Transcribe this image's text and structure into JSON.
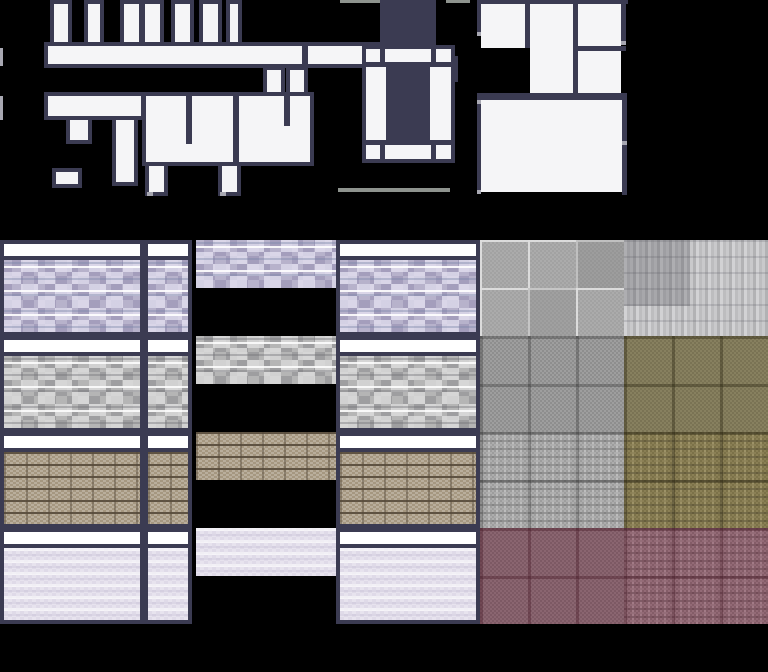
{
  "canvas": {
    "width": 768,
    "height": 672,
    "background": "#000000"
  },
  "palette": {
    "outline_dark_navy": "#3b3b52",
    "wall_white": "#f5f5f7",
    "band_white": "#ffffff",
    "doorway_cap_gray": "#a8a8b2",
    "ground_line_gray": "#8e938e",
    "stone_purple": "#b7b2cb",
    "stone_gray": "#b5b5b5",
    "brick_brown": "#a59780",
    "tile_lavender": "#e7e3ee",
    "floor_light_gray": "#ababab",
    "plank_gray": "#c2c2c4",
    "checker_gray": "#989898",
    "checker_olive": "#81795c",
    "checker_maroon": "#846070"
  },
  "top_section": {
    "pieces": [
      {
        "name": "wall-stub-1",
        "kind": "white",
        "x": 50,
        "y": 0,
        "w": 22,
        "h": 46
      },
      {
        "name": "wall-stub-2",
        "kind": "white",
        "x": 84,
        "y": 0,
        "w": 20,
        "h": 46
      },
      {
        "name": "wall-stub-3",
        "kind": "white",
        "x": 120,
        "y": 0,
        "w": 23,
        "h": 48
      },
      {
        "name": "wall-stub-4",
        "kind": "white",
        "x": 141,
        "y": 0,
        "w": 23,
        "h": 48
      },
      {
        "name": "wall-stub-5",
        "kind": "white",
        "x": 171,
        "y": 0,
        "w": 23,
        "h": 48
      },
      {
        "name": "wall-stub-6",
        "kind": "white",
        "x": 199,
        "y": 0,
        "w": 23,
        "h": 48
      },
      {
        "name": "wall-stub-7",
        "kind": "white",
        "x": 226,
        "y": 0,
        "w": 16,
        "h": 48
      },
      {
        "name": "corridor-upper-left",
        "kind": "white",
        "x": 44,
        "y": 42,
        "w": 262,
        "h": 26
      },
      {
        "name": "corridor-upper-right",
        "kind": "white",
        "x": 304,
        "y": 42,
        "w": 94,
        "h": 26
      },
      {
        "name": "corridor-upper-step",
        "kind": "white",
        "x": 396,
        "y": 56,
        "w": 62,
        "h": 26
      },
      {
        "name": "corridor-drop-stub-1",
        "kind": "white",
        "x": 263,
        "y": 66,
        "w": 22,
        "h": 30
      },
      {
        "name": "corridor-drop-stub-2",
        "kind": "white",
        "x": 286,
        "y": 66,
        "w": 22,
        "h": 30
      },
      {
        "name": "edge-sliver-1",
        "kind": "cap",
        "x": 0,
        "y": 48,
        "w": 3,
        "h": 18
      },
      {
        "name": "edge-sliver-2",
        "kind": "cap",
        "x": 0,
        "y": 96,
        "w": 3,
        "h": 24
      },
      {
        "name": "room-blob",
        "kind": "white",
        "x": 142,
        "y": 92,
        "w": 172,
        "h": 74
      },
      {
        "name": "corridor-lower-left",
        "kind": "white",
        "x": 44,
        "y": 92,
        "w": 101,
        "h": 28
      },
      {
        "name": "blob-divider-1",
        "kind": "dark",
        "x": 186,
        "y": 92,
        "w": 6,
        "h": 52
      },
      {
        "name": "blob-divider-2",
        "kind": "dark",
        "x": 233,
        "y": 92,
        "w": 6,
        "h": 74
      },
      {
        "name": "blob-divider-3",
        "kind": "dark",
        "x": 284,
        "y": 92,
        "w": 6,
        "h": 34
      },
      {
        "name": "hook-stub",
        "kind": "white",
        "x": 66,
        "y": 116,
        "w": 26,
        "h": 28
      },
      {
        "name": "tall-stub",
        "kind": "white",
        "x": 112,
        "y": 116,
        "w": 26,
        "h": 70
      },
      {
        "name": "low-left-piece",
        "kind": "white",
        "x": 52,
        "y": 168,
        "w": 30,
        "h": 20
      },
      {
        "name": "blob-foot-1",
        "kind": "white",
        "x": 145,
        "y": 162,
        "w": 23,
        "h": 34
      },
      {
        "name": "blob-foot-2",
        "kind": "white",
        "x": 218,
        "y": 162,
        "w": 23,
        "h": 34
      },
      {
        "name": "foot-cap-1",
        "kind": "cap",
        "x": 147,
        "y": 192,
        "w": 6,
        "h": 4
      },
      {
        "name": "foot-cap-2",
        "kind": "cap",
        "x": 220,
        "y": 192,
        "w": 6,
        "h": 4
      },
      {
        "name": "roof-line-left",
        "kind": "line",
        "x": 340,
        "y": 0,
        "w": 40,
        "h": 3
      },
      {
        "name": "roof-line-right",
        "kind": "line",
        "x": 446,
        "y": 0,
        "w": 24,
        "h": 3
      },
      {
        "name": "chimney",
        "kind": "dark",
        "x": 380,
        "y": 0,
        "w": 56,
        "h": 46
      },
      {
        "name": "window-frame",
        "kind": "white",
        "x": 362,
        "y": 45,
        "w": 93,
        "h": 118
      },
      {
        "name": "window-rail-top",
        "kind": "dark",
        "x": 362,
        "y": 62,
        "w": 93,
        "h": 5
      },
      {
        "name": "window-rail-bottom",
        "kind": "dark",
        "x": 362,
        "y": 140,
        "w": 93,
        "h": 5
      },
      {
        "name": "window-mullion-tl",
        "kind": "dark",
        "x": 380,
        "y": 45,
        "w": 5,
        "h": 21
      },
      {
        "name": "window-mullion-tr",
        "kind": "dark",
        "x": 431,
        "y": 45,
        "w": 5,
        "h": 21
      },
      {
        "name": "window-mullion-bl",
        "kind": "dark",
        "x": 380,
        "y": 141,
        "w": 5,
        "h": 22
      },
      {
        "name": "window-mullion-br",
        "kind": "dark",
        "x": 431,
        "y": 141,
        "w": 5,
        "h": 22
      },
      {
        "name": "window-opening",
        "kind": "dark",
        "x": 386,
        "y": 66,
        "w": 44,
        "h": 76
      },
      {
        "name": "ground-line",
        "kind": "line",
        "x": 338,
        "y": 188,
        "w": 112,
        "h": 4
      },
      {
        "name": "room-a",
        "kind": "flat",
        "x": 481,
        "y": 4,
        "w": 44,
        "h": 44
      },
      {
        "name": "room-b",
        "kind": "flat",
        "x": 530,
        "y": 4,
        "w": 43,
        "h": 89
      },
      {
        "name": "room-c",
        "kind": "flat",
        "x": 578,
        "y": 4,
        "w": 43,
        "h": 42
      },
      {
        "name": "room-d",
        "kind": "flat",
        "x": 578,
        "y": 51,
        "w": 43,
        "h": 42
      },
      {
        "name": "room-large",
        "kind": "flat",
        "x": 481,
        "y": 100,
        "w": 141,
        "h": 92
      },
      {
        "name": "rooms-wall-top",
        "kind": "dark",
        "x": 477,
        "y": 0,
        "w": 151,
        "h": 4
      },
      {
        "name": "rooms-wall-left-upper",
        "kind": "dark",
        "x": 477,
        "y": 4,
        "w": 4,
        "h": 28
      },
      {
        "name": "rooms-cap-left-upper",
        "kind": "cap",
        "x": 477,
        "y": 32,
        "w": 4,
        "h": 4
      },
      {
        "name": "rooms-divider-ab",
        "kind": "dark",
        "x": 525,
        "y": 4,
        "w": 5,
        "h": 44
      },
      {
        "name": "rooms-divider-bc",
        "kind": "dark",
        "x": 573,
        "y": 4,
        "w": 5,
        "h": 89
      },
      {
        "name": "rooms-wall-right-upper",
        "kind": "dark",
        "x": 621,
        "y": 4,
        "w": 5,
        "h": 37
      },
      {
        "name": "rooms-cap-right-upper",
        "kind": "cap",
        "x": 621,
        "y": 41,
        "w": 5,
        "h": 4
      },
      {
        "name": "rooms-wall-cd",
        "kind": "dark",
        "x": 578,
        "y": 46,
        "w": 48,
        "h": 5
      },
      {
        "name": "rooms-wall-main",
        "kind": "dark",
        "x": 477,
        "y": 93,
        "w": 150,
        "h": 7
      },
      {
        "name": "rooms-cap-left-mid",
        "kind": "cap",
        "x": 477,
        "y": 100,
        "w": 4,
        "h": 4
      },
      {
        "name": "rooms-wall-left-lower",
        "kind": "dark",
        "x": 477,
        "y": 104,
        "w": 4,
        "h": 86
      },
      {
        "name": "rooms-cap-left-lower",
        "kind": "cap",
        "x": 477,
        "y": 190,
        "w": 4,
        "h": 4
      },
      {
        "name": "rooms-wall-right-mid",
        "kind": "dark",
        "x": 622,
        "y": 100,
        "w": 5,
        "h": 41
      },
      {
        "name": "rooms-cap-right-mid",
        "kind": "cap",
        "x": 622,
        "y": 141,
        "w": 5,
        "h": 4
      },
      {
        "name": "rooms-wall-right-lower",
        "kind": "dark",
        "x": 622,
        "y": 145,
        "w": 5,
        "h": 50
      }
    ]
  },
  "tileset": {
    "wall_rows": [
      {
        "material": "purple-stone",
        "label": "purple stone wall",
        "y": 240,
        "tiles": [
          {
            "name": "wall-tile-wide-left",
            "x": 0,
            "w": 144
          },
          {
            "name": "wall-tile-narrow",
            "x": 144,
            "w": 48
          },
          {
            "name": "wall-tile-wide-right",
            "x": 336,
            "w": 144
          }
        ],
        "swatch": {
          "name": "texture-swatch",
          "x": 196,
          "w": 140,
          "h": 48
        }
      },
      {
        "material": "gray-stone",
        "label": "gray stone wall",
        "y": 336,
        "tiles": [
          {
            "name": "wall-tile-wide-left",
            "x": 0,
            "w": 144
          },
          {
            "name": "wall-tile-narrow",
            "x": 144,
            "w": 48
          },
          {
            "name": "wall-tile-wide-right",
            "x": 336,
            "w": 144
          }
        ],
        "swatch": {
          "name": "texture-swatch",
          "x": 196,
          "w": 140,
          "h": 48
        }
      },
      {
        "material": "brown-brick",
        "label": "brown brick wall",
        "y": 432,
        "tiles": [
          {
            "name": "wall-tile-wide-left",
            "x": 0,
            "w": 144
          },
          {
            "name": "wall-tile-narrow",
            "x": 144,
            "w": 48
          },
          {
            "name": "wall-tile-wide-right",
            "x": 336,
            "w": 144
          }
        ],
        "swatch": {
          "name": "texture-swatch",
          "x": 196,
          "w": 140,
          "h": 48
        }
      },
      {
        "material": "lavender-tile",
        "label": "lavender tiled wall",
        "y": 528,
        "tiles": [
          {
            "name": "wall-tile-wide-left",
            "x": 0,
            "w": 144
          },
          {
            "name": "wall-tile-narrow",
            "x": 144,
            "w": 48
          },
          {
            "name": "wall-tile-wide-right",
            "x": 336,
            "w": 144
          }
        ],
        "swatch": {
          "name": "texture-swatch",
          "x": 196,
          "w": 140,
          "h": 48
        }
      }
    ],
    "wall_tile_height": 96,
    "floor_tiles": [
      {
        "name": "floor-gray-grid",
        "texture": "f-grid",
        "x": 480,
        "y": 240,
        "w": 144,
        "h": 96
      },
      {
        "name": "floor-gray-planks",
        "texture": "f-planks",
        "x": 624,
        "y": 240,
        "w": 144,
        "h": 96
      },
      {
        "name": "floor-checker-gray",
        "texture": "f-checker-gray",
        "x": 480,
        "y": 336,
        "w": 144,
        "h": 96
      },
      {
        "name": "floor-checker-olive",
        "texture": "f-checker-olive",
        "x": 624,
        "y": 336,
        "w": 144,
        "h": 96
      },
      {
        "name": "floor-ornate-gray",
        "texture": "f-ornate-gray",
        "x": 480,
        "y": 432,
        "w": 144,
        "h": 96
      },
      {
        "name": "floor-ornate-olive",
        "texture": "f-ornate-olive",
        "x": 624,
        "y": 432,
        "w": 144,
        "h": 96
      },
      {
        "name": "floor-checker-maroon",
        "texture": "f-checker-maroon",
        "x": 480,
        "y": 528,
        "w": 144,
        "h": 96
      },
      {
        "name": "floor-ornate-maroon",
        "texture": "f-ornate-maroon",
        "x": 624,
        "y": 528,
        "w": 144,
        "h": 96
      }
    ]
  }
}
